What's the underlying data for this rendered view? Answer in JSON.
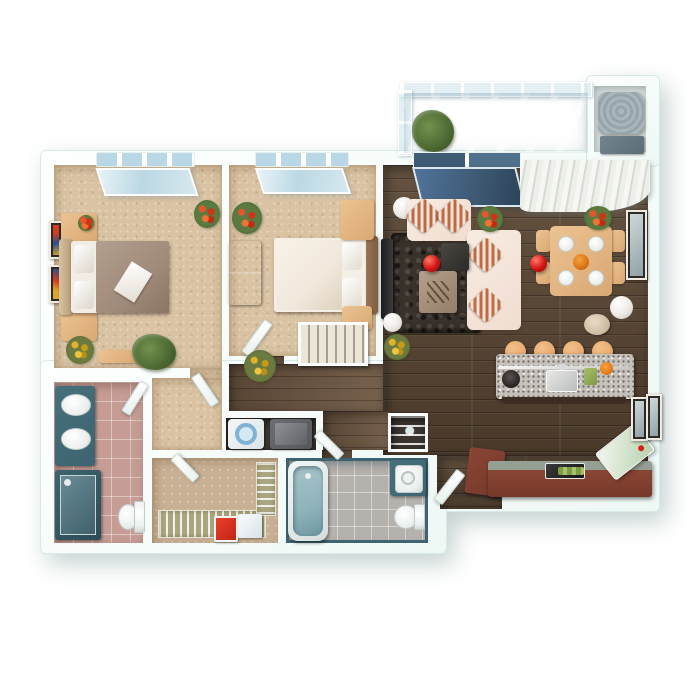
{
  "scene": {
    "kind": "3d-rendered-apartment-floor-plan",
    "view": "top-down dollhouse view, two-bedroom two-bath unit with balcony",
    "background": "#ffffff"
  },
  "palette": {
    "wall": "#eef8f5",
    "walledge": "#d8eae6",
    "carpet": "#d9c3a3",
    "wood": "#5a4633",
    "hallwood": "#6e5742",
    "tilepink": "#c69d95",
    "tilegray": "#b5b1ac",
    "closetfloor": "#c8b094",
    "storagefloor": "#dde3e1",
    "teal": "#3d6470",
    "windowglass": "#b9d7e4",
    "sofacream": "#f0ddd0",
    "pillowrust": "#c06a45",
    "rug": "#39322b",
    "redlamp": "#d31414",
    "oak": "#d9a873",
    "darkwood": "#503826",
    "granite": "#c6c1ba",
    "stooltan": "#e8aa70",
    "cabinetred": "#76382a",
    "duvettaupe": "#a08a79",
    "duvetcream": "#f1e8dc",
    "flowerorange": "#e4572c",
    "floweryellow": "#e0b32a",
    "plantgreen": "#49652f",
    "washerblue": "#7fb2d4",
    "dryergray": "#54585c",
    "tubteal": "#8fb3bb",
    "acgray": "#97a4aa",
    "glassdark": "#3e5a74"
  },
  "rooms": [
    {
      "name": "bedroom-1",
      "floor": "carpet",
      "furniture": [
        "window",
        "double-bed-taupe-duvet",
        "nightstand",
        "nightstand",
        "wall-art",
        "wall-art",
        "bench",
        "potted-plant",
        "yellow-flowers",
        "orange-flowers"
      ]
    },
    {
      "name": "bedroom-2",
      "floor": "carpet",
      "furniture": [
        "window",
        "double-bed-cream-duvet",
        "dresser",
        "desk",
        "nightstand",
        "closet-organizer",
        "red-flowers"
      ]
    },
    {
      "name": "living-room",
      "floor": "dark-wood",
      "furniture": [
        "sectional-sofa",
        "striped-cushions",
        "shag-rug",
        "coffee-table",
        "glass-side-table",
        "red-sphere-lamp",
        "white-floor-lamp",
        "tv-console",
        "white-side-table",
        "sliding-glass-door",
        "flower-pot"
      ]
    },
    {
      "name": "dining-area",
      "floor": "dark-wood",
      "furniture": [
        "dining-table",
        "chair",
        "chair",
        "chair",
        "chair",
        "place-settings",
        "red-sphere-lamp",
        "vertical-blinds",
        "wall-art",
        "white-floor-lamp",
        "pouf",
        "red-flowers"
      ]
    },
    {
      "name": "kitchen",
      "floor": "dark-wood",
      "furniture": [
        "island-with-granite-top",
        "sink",
        "cooktop",
        "bar-stool",
        "bar-stool",
        "bar-stool",
        "bar-stool",
        "base-cabinets",
        "stove",
        "corner-counter",
        "angled-fridge",
        "wall-art",
        "wall-art"
      ]
    },
    {
      "name": "hallway",
      "floor": "dark-wood",
      "furniture": [
        "yellow-flowers",
        "yellow-flowers"
      ]
    },
    {
      "name": "bathroom-1",
      "floor": "pink-tile",
      "furniture": [
        "double-sink-vanity",
        "walk-in-shower",
        "toilet"
      ]
    },
    {
      "name": "bathroom-2",
      "floor": "gray-tile",
      "furniture": [
        "bathtub",
        "vanity-sink",
        "toilet"
      ]
    },
    {
      "name": "laundry-closet",
      "floor": "dark",
      "furniture": [
        "washer",
        "dryer"
      ]
    },
    {
      "name": "walk-in-closet",
      "floor": "tan-carpet",
      "furniture": [
        "wire-shelving",
        "wire-shelving",
        "red-storage-box",
        "white-storage-box"
      ]
    },
    {
      "name": "linen-closet",
      "floor": "dark-wood",
      "furniture": [
        "shelves"
      ]
    },
    {
      "name": "entry",
      "floor": "dark-wood",
      "furniture": [
        "front-door"
      ]
    },
    {
      "name": "balcony",
      "floor": "glass",
      "furniture": [
        "glass-railing",
        "potted-plant"
      ]
    },
    {
      "name": "mechanical-closet",
      "floor": "light",
      "furniture": [
        "ac-condenser",
        "utility-box"
      ]
    }
  ]
}
